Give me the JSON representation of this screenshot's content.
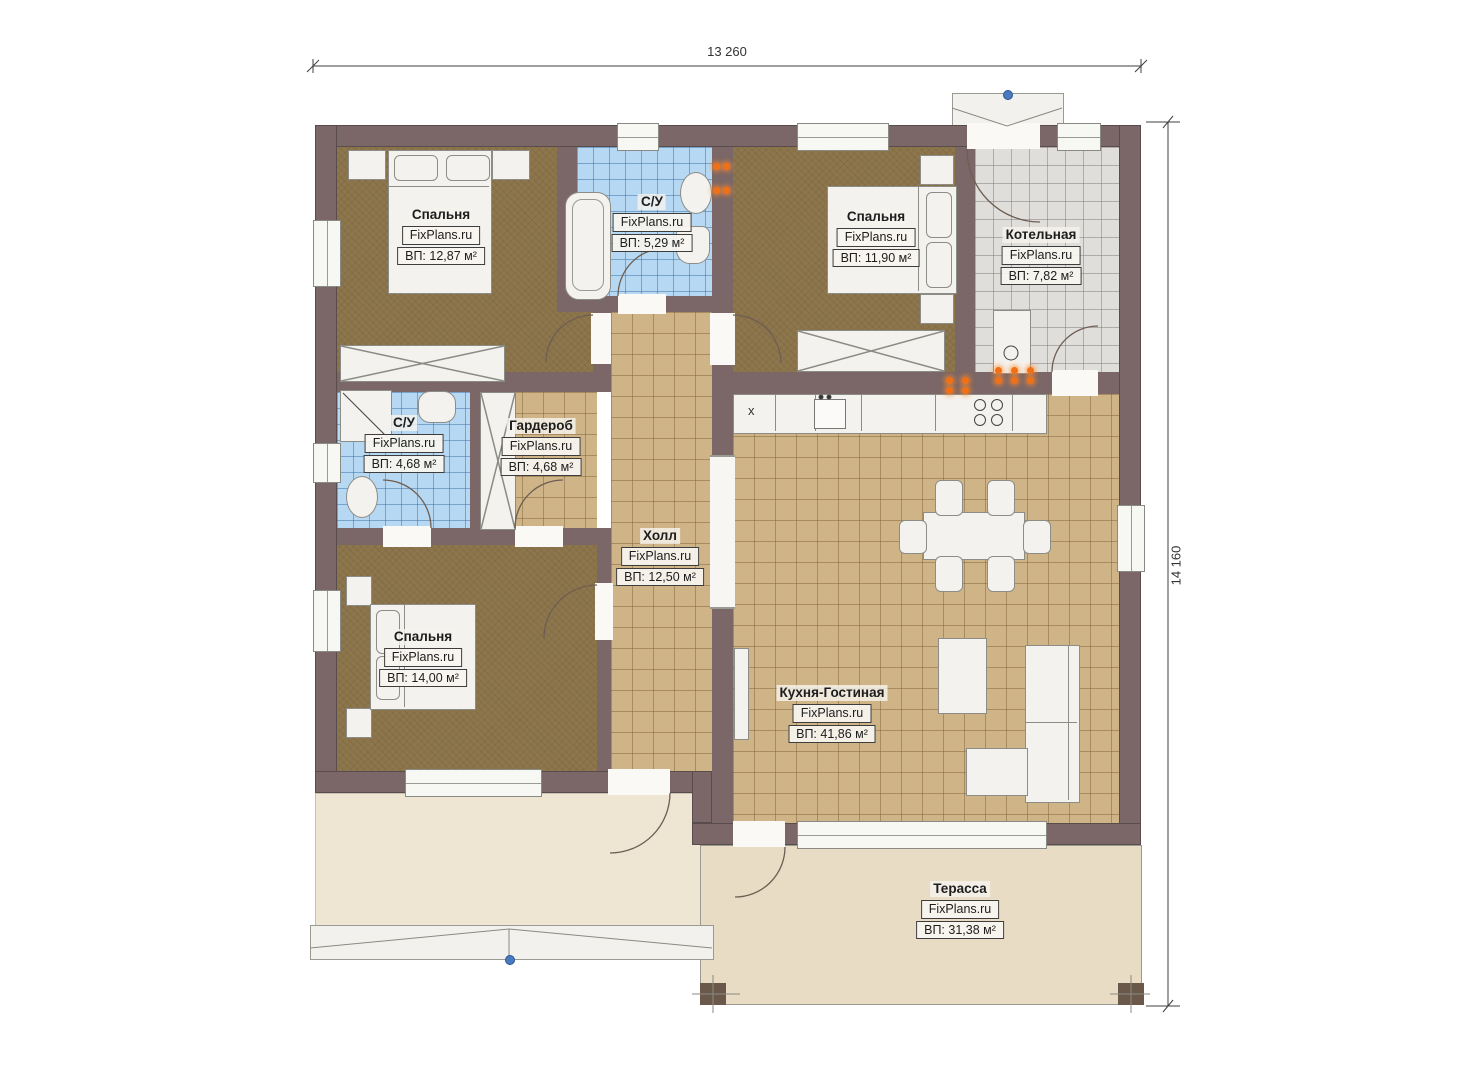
{
  "plan_title": "Floor plan",
  "brand": "FixPlans.ru",
  "dimensions": {
    "width": "13 260",
    "height": "14 160"
  },
  "rooms": [
    {
      "name": "Спальня",
      "brand": "FixPlans.ru",
      "area": "ВП: 12,87 м²"
    },
    {
      "name": "С/У",
      "brand": "FixPlans.ru",
      "area": "ВП: 5,29 м²"
    },
    {
      "name": "Спальня",
      "brand": "FixPlans.ru",
      "area": "ВП: 11,90 м²"
    },
    {
      "name": "Котельная",
      "brand": "FixPlans.ru",
      "area": "ВП: 7,82 м²"
    },
    {
      "name": "С/У",
      "brand": "FixPlans.ru",
      "area": "ВП: 4,68 м²"
    },
    {
      "name": "Гардероб",
      "brand": "FixPlans.ru",
      "area": "ВП: 4,68 м²"
    },
    {
      "name": "Холл",
      "brand": "FixPlans.ru",
      "area": "ВП: 12,50 м²"
    },
    {
      "name": "Спальня",
      "brand": "FixPlans.ru",
      "area": "ВП: 14,00 м²"
    },
    {
      "name": "Кухня-Гостиная",
      "brand": "FixPlans.ru",
      "area": "ВП: 41,86 м²"
    },
    {
      "name": "Терасса",
      "brand": "FixPlans.ru",
      "area": "ВП: 31,38 м²"
    }
  ],
  "symbols": {
    "fridge": "x"
  },
  "colors": {
    "wall": "#7b6767",
    "carpet": "#8d764c",
    "tile_tan": "#cfb487",
    "tile_blue": "#b7d8f2",
    "tile_gray": "#e0dedb",
    "terrace": "#e8dcc5",
    "porch": "#efe5d3",
    "socket_orange": "#f07018",
    "marker_blue": "#4a79c0"
  }
}
